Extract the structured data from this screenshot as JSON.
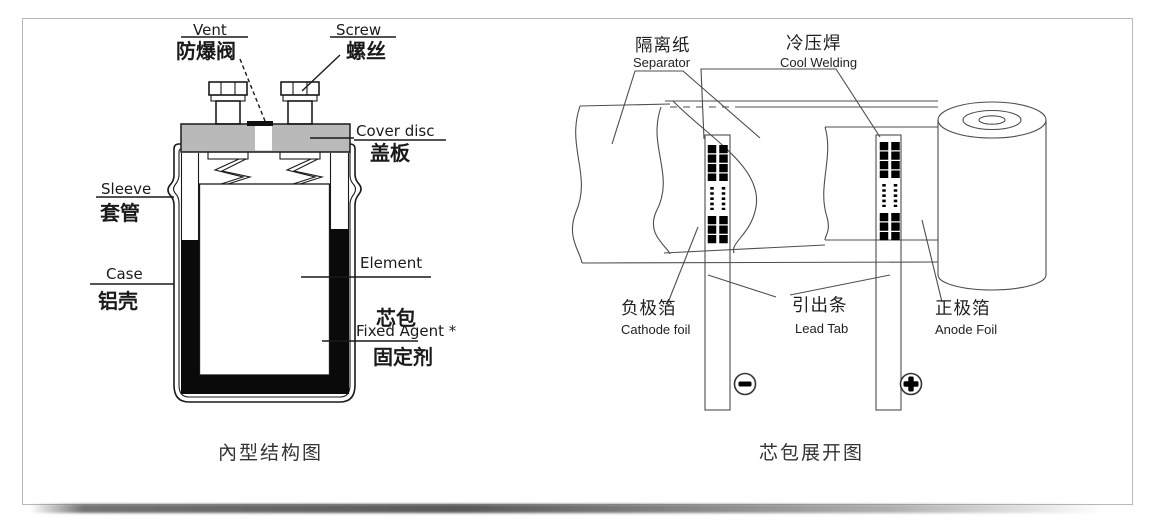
{
  "page": {
    "background": "#ffffff",
    "card_border_color": "#b9b9b9"
  },
  "left_diagram": {
    "caption": "內型结构图",
    "cover_fill_color": "#b9b9b9",
    "line_color": "#1a1a1a",
    "labels": {
      "vent_en": "Vent",
      "vent_zh": "防爆阀",
      "screw_en": "Screw",
      "screw_zh": "螺丝",
      "cover_en": "Cover disc",
      "cover_zh": "盖板",
      "sleeve_en": "Sleeve",
      "sleeve_zh": "套管",
      "case_en": "Case",
      "case_zh": "铝壳",
      "element_en": "Element",
      "element_zh": "芯包",
      "fixed_en": "Fixed Agent *",
      "fixed_zh": "固定剂"
    }
  },
  "right_diagram": {
    "caption": "芯包展开图",
    "line_color": "#4d4d4d",
    "weld_color": "#000000",
    "labels": {
      "separator_zh": "隔离纸",
      "separator_en": "Separator",
      "welding_zh": "冷压焊",
      "welding_en": "Cool Welding",
      "cathode_zh": "负极箔",
      "cathode_en": "Cathode foil",
      "leadtab_zh": "引出条",
      "leadtab_en": "Lead Tab",
      "anode_zh": "正极箔",
      "anode_en": "Anode Foil"
    },
    "polarity": {
      "negative": "−",
      "positive": "+"
    }
  }
}
